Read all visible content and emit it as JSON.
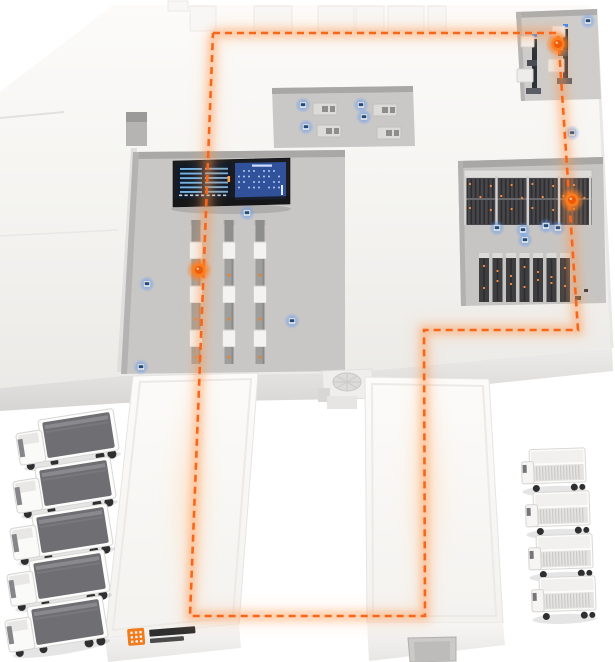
{
  "scene": {
    "route": {
      "points": "213,33 558,33 578,330 424,330 425,616 190,616 213,33",
      "color": "#f9661a",
      "glow": "#ff8e3f",
      "dash": "7 5",
      "width": 2.6
    },
    "markers": [
      {
        "x": 558,
        "y": 44
      },
      {
        "x": 572,
        "y": 200
      },
      {
        "x": 199,
        "y": 270
      }
    ],
    "devices": [
      {
        "x": 147,
        "y": 284
      },
      {
        "x": 141,
        "y": 367
      },
      {
        "x": 247,
        "y": 213
      },
      {
        "x": 292,
        "y": 321
      },
      {
        "x": 303,
        "y": 105
      },
      {
        "x": 306,
        "y": 127
      },
      {
        "x": 361,
        "y": 105
      },
      {
        "x": 364,
        "y": 117
      },
      {
        "x": 497,
        "y": 228
      },
      {
        "x": 523,
        "y": 230
      },
      {
        "x": 546,
        "y": 226
      },
      {
        "x": 558,
        "y": 228
      },
      {
        "x": 525,
        "y": 240
      },
      {
        "x": 572,
        "y": 133
      },
      {
        "x": 588,
        "y": 21
      }
    ],
    "conveyors": {
      "top": 220,
      "lines_x": [
        196,
        229,
        260
      ],
      "box_count": 3
    },
    "rack_top": {
      "x": 464,
      "y": 170,
      "w": 128
    },
    "rack_units": {
      "x": 479,
      "y": 253,
      "count": 7,
      "step": 13.5
    },
    "workstations": [
      {
        "x": 313,
        "y": 103
      },
      {
        "x": 317,
        "y": 125
      },
      {
        "x": 373,
        "y": 104
      },
      {
        "x": 377,
        "y": 127
      }
    ],
    "machines": [
      {
        "x": 521,
        "y": 36
      },
      {
        "x": 552,
        "y": 26
      }
    ],
    "trucks_left": [
      {
        "x": 14,
        "y": 424
      },
      {
        "x": 11,
        "y": 472
      },
      {
        "x": 8,
        "y": 519
      },
      {
        "x": 5,
        "y": 565
      },
      {
        "x": 3,
        "y": 611
      }
    ],
    "trucks_right": [
      {
        "x": 521,
        "y": 450
      },
      {
        "x": 525,
        "y": 493
      },
      {
        "x": 528,
        "y": 536
      },
      {
        "x": 531,
        "y": 578
      }
    ],
    "board": {
      "left_rows": 6,
      "right_rows": 4,
      "right_cols": 9
    },
    "logo": {
      "x": 127,
      "y": 629,
      "mark": "#f07b1d",
      "text": "#2e2e2e"
    },
    "colors": {
      "rack_dot": "#ff8c3a",
      "conveyor_dot": "#e8832f",
      "blue_glow": "#5aa7ff"
    }
  }
}
